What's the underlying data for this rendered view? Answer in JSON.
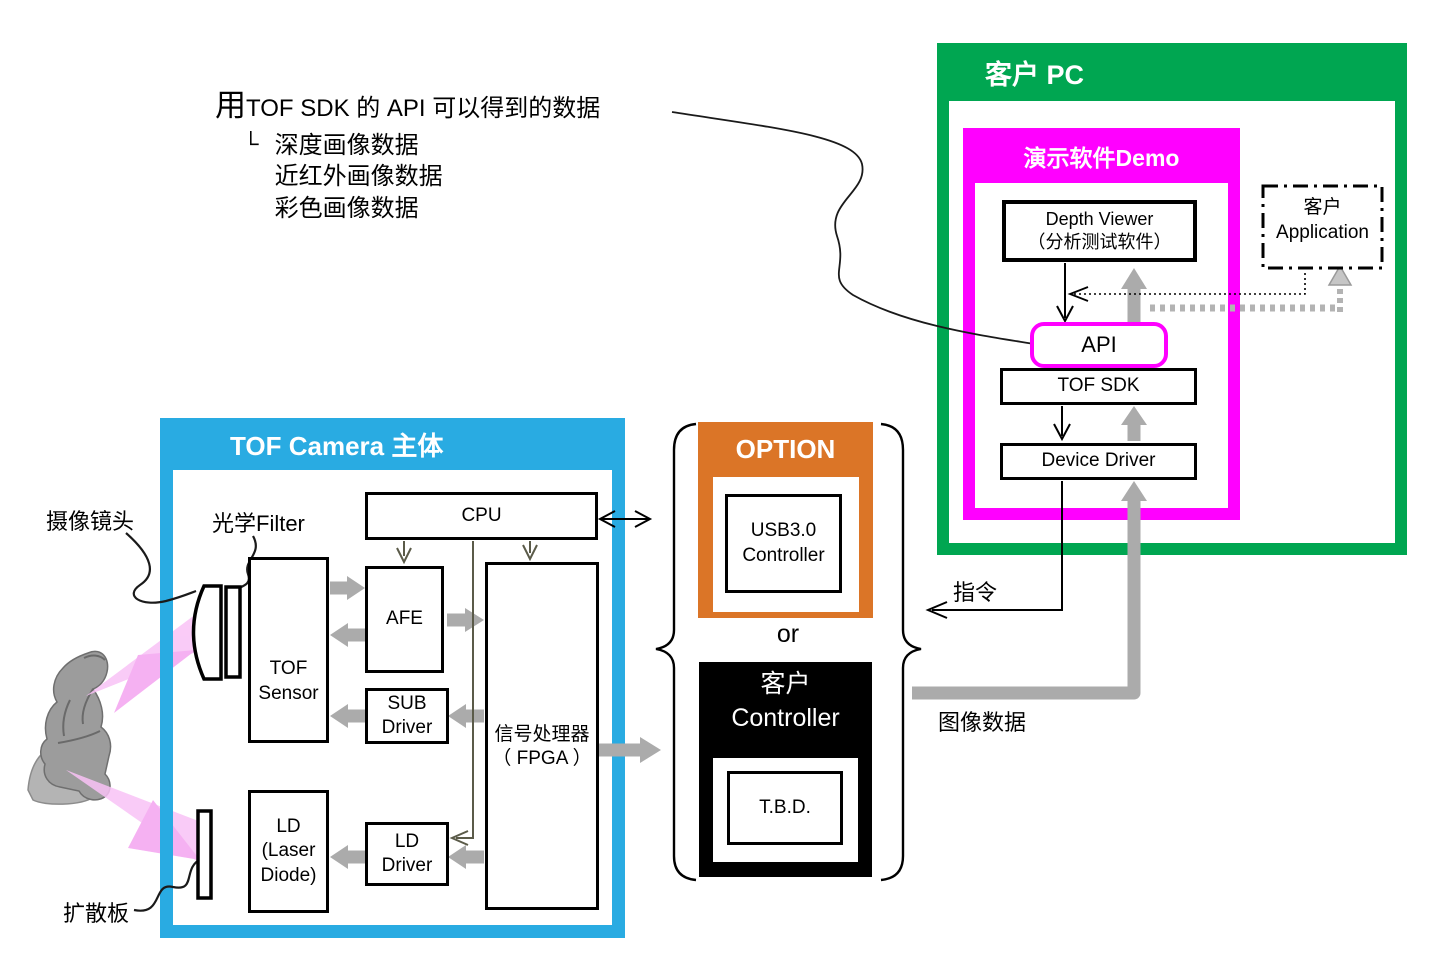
{
  "annotation": {
    "line1_big": "用",
    "line1": "TOF SDK 的 API 可以得到的数据",
    "tree_glyph": "└",
    "items": [
      "深度画像数据",
      "近红外画像数据",
      "彩色画像数据"
    ]
  },
  "pc": {
    "title": "客户 PC",
    "demo": {
      "title": "演示软件Demo",
      "depth_viewer": {
        "line1": "Depth Viewer",
        "line2": "（分析测试软件）"
      },
      "api_label": "API",
      "tof_sdk_label": "TOF SDK",
      "device_driver_label": "Device Driver"
    },
    "customer_app": {
      "line1": "客户",
      "line2": "Application"
    }
  },
  "camera": {
    "title": "TOF Camera 主体",
    "cpu_label": "CPU",
    "tof_sensor": {
      "line1": "TOF",
      "line2": "Sensor"
    },
    "afe_label": "AFE",
    "sub_driver": {
      "line1": "SUB",
      "line2": "Driver"
    },
    "fpga": {
      "line1": "信号处理器",
      "line2": "（ FPGA ）"
    },
    "ld": {
      "line1": "LD",
      "line2": "(Laser",
      "line3": "Diode)"
    },
    "ld_driver": {
      "line1": "LD",
      "line2": "Driver"
    }
  },
  "option": {
    "title": "OPTION",
    "usb": {
      "line1": "USB3.0",
      "line2": "Controller"
    }
  },
  "or_label": "or",
  "controller": {
    "title_line1": "客户",
    "title_line2": "Controller",
    "tbd_label": "T.B.D."
  },
  "callouts": {
    "camera_lens": "摄像镜头",
    "optical_filter": "光学Filter",
    "diffuser": "扩散板",
    "command": "指令",
    "image_data": "图像数据"
  },
  "colors": {
    "green": "#00a651",
    "magenta": "#ff00ff",
    "cyan": "#29abe2",
    "orange": "#db7527",
    "black": "#000000",
    "arrow_gray": "#ababab",
    "beam_pink": "#f7b3f3"
  }
}
